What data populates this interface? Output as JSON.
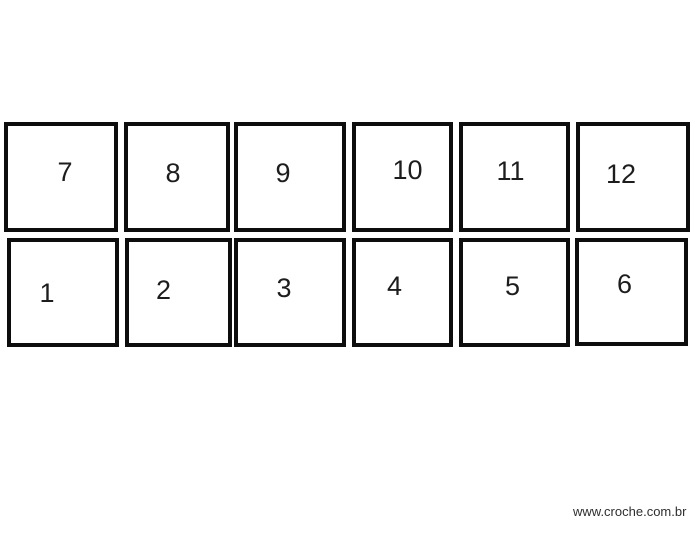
{
  "squares": [
    {
      "number": "7"
    },
    {
      "number": "8"
    },
    {
      "number": "9"
    },
    {
      "number": "10"
    },
    {
      "number": "11"
    },
    {
      "number": "12"
    },
    {
      "number": "1"
    },
    {
      "number": "2"
    },
    {
      "number": "3"
    },
    {
      "number": "4"
    },
    {
      "number": "5"
    },
    {
      "number": "6"
    }
  ],
  "watermark": {
    "text": "www.croche.com.br"
  },
  "colors": {
    "background": "#ffffff",
    "square_border": "#0d0d0d",
    "number_text": "#1d1d1d",
    "watermark_text": "#2e2e2e"
  }
}
